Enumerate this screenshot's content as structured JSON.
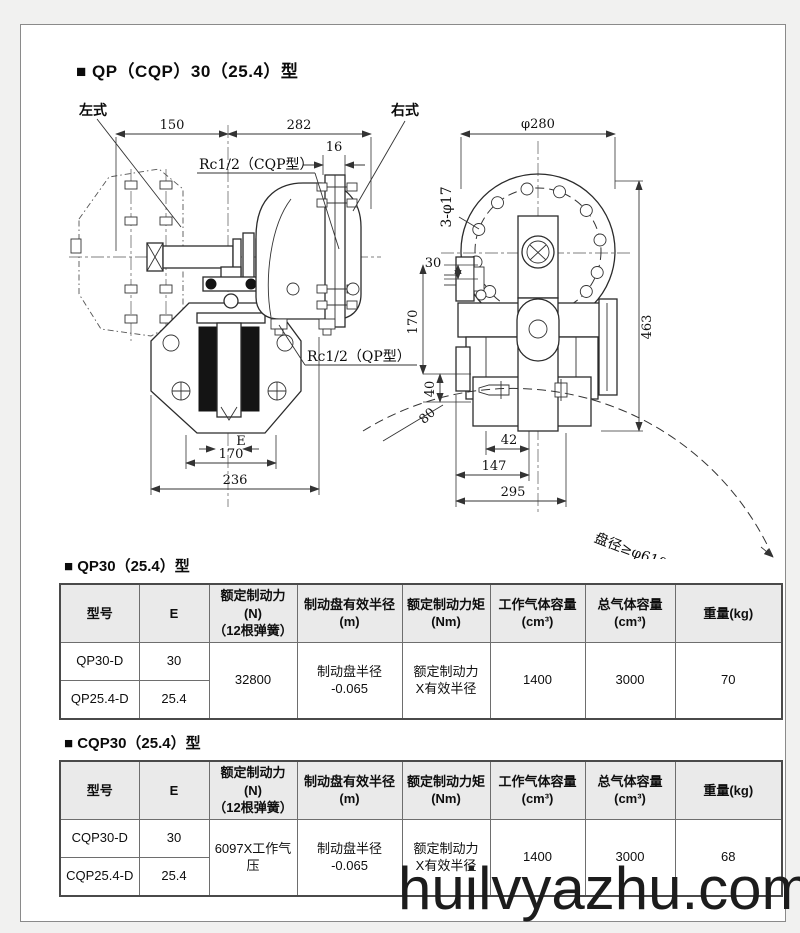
{
  "page": {
    "title": "■ QP（CQP）30（25.4）型",
    "watermark": "huilvyazhu.com"
  },
  "drawing": {
    "left_view": {
      "label_left": "左式",
      "label_right": "右式",
      "dim_width_left": "150",
      "dim_width_right": "282",
      "dim_flange": "16",
      "port_cqp": "Rc1/2（CQP型）",
      "port_qp": "Rc1/2（QP型）",
      "dim_gap": "E",
      "dim_pad_span": "170",
      "dim_total_width": "236"
    },
    "right_view": {
      "dim_diameter": "φ280",
      "dim_holes": "3-φ17",
      "dim_top": "30",
      "dim_height1": "170",
      "dim_height2": "40",
      "dim_height3": "80",
      "dim_total_height": "463",
      "dim_b1": "42",
      "dim_b2": "147",
      "dim_b3": "295",
      "disc_note": "盘径≥φ610"
    }
  },
  "table_qp": {
    "section_title": "■ QP30（25.4）型",
    "headers": [
      "型号",
      "E",
      "额定制动力(N)\n（12根弹簧）",
      "制动盘有效半径\n(m)",
      "额定制动力矩\n(Nm)",
      "工作气体容量\n(cm³)",
      "总气体容量\n(cm³)",
      "重量(kg)"
    ],
    "rows": [
      {
        "model": "QP30-D",
        "e": "30"
      },
      {
        "model": "QP25.4-D",
        "e": "25.4"
      }
    ],
    "merged": {
      "force": "32800",
      "radius": "制动盘半径\n-0.065",
      "torque": "额定制动力\nX有效半径",
      "work_volume": "1400",
      "total_volume": "3000",
      "weight": "70"
    }
  },
  "table_cqp": {
    "section_title": "■ CQP30（25.4）型",
    "headers": [
      "型号",
      "E",
      "额定制动力(N)\n（12根弹簧）",
      "制动盘有效半径\n(m)",
      "额定制动力矩\n(Nm)",
      "工作气体容量\n(cm³)",
      "总气体容量\n(cm³)",
      "重量(kg)"
    ],
    "rows": [
      {
        "model": "CQP30-D",
        "e": "30"
      },
      {
        "model": "CQP25.4-D",
        "e": "25.4"
      }
    ],
    "merged": {
      "force": "6097X工作气压",
      "radius": "制动盘半径\n-0.065",
      "torque": "额定制动力\nX有效半径",
      "work_volume": "1400",
      "total_volume": "3000",
      "weight": "68"
    }
  }
}
